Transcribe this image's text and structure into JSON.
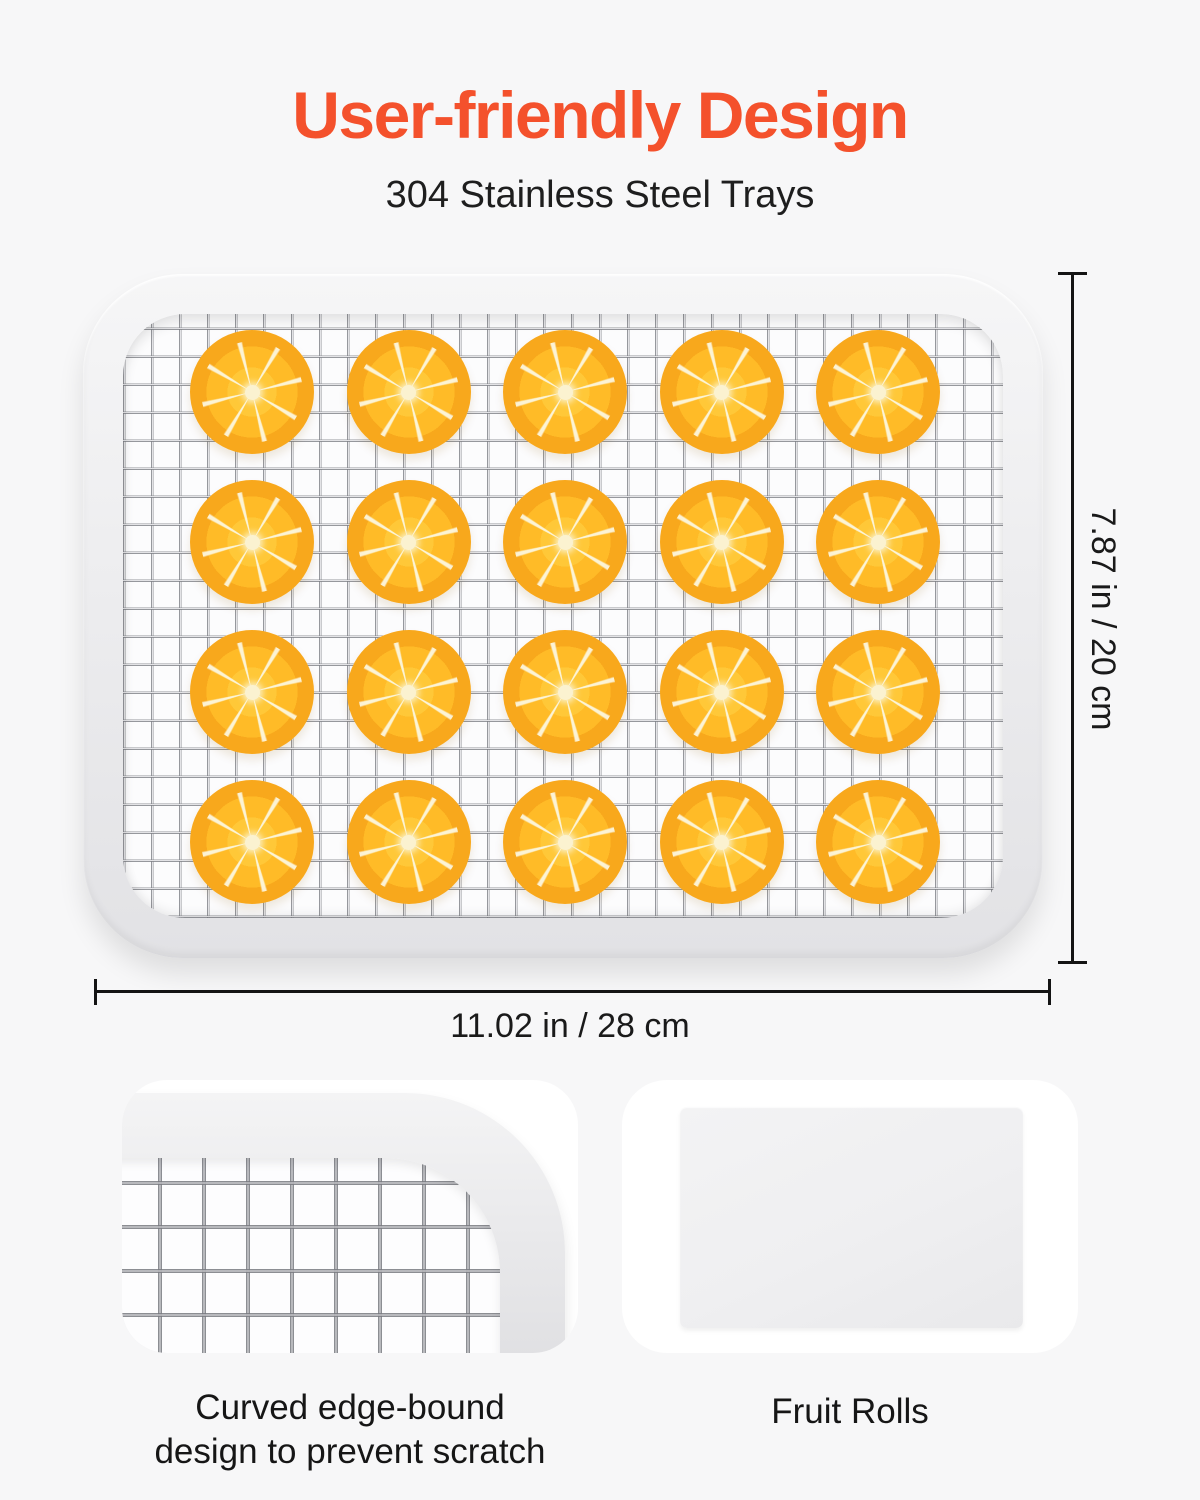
{
  "header": {
    "title": "User-friendly Design",
    "subtitle": "304 Stainless Steel Trays"
  },
  "tray": {
    "rows": 4,
    "cols": 5,
    "slice_count": 20,
    "item": "orange-slice"
  },
  "dimensions": {
    "height_label": "7.87 in / 20 cm",
    "width_label": "11.02 in / 28 cm"
  },
  "features": [
    {
      "caption": "Curved edge-bound design to prevent scratch",
      "caption_line1": "Curved edge-bound",
      "caption_line2": "design to prevent scratch"
    },
    {
      "caption": "Fruit Rolls"
    }
  ],
  "colors": {
    "accent_orange": "#f4512c",
    "text_dark": "#1a1a1a",
    "page_background": "#f7f7f8",
    "slice_orange": "#ffbb27",
    "frame_gray": "#ededef"
  }
}
